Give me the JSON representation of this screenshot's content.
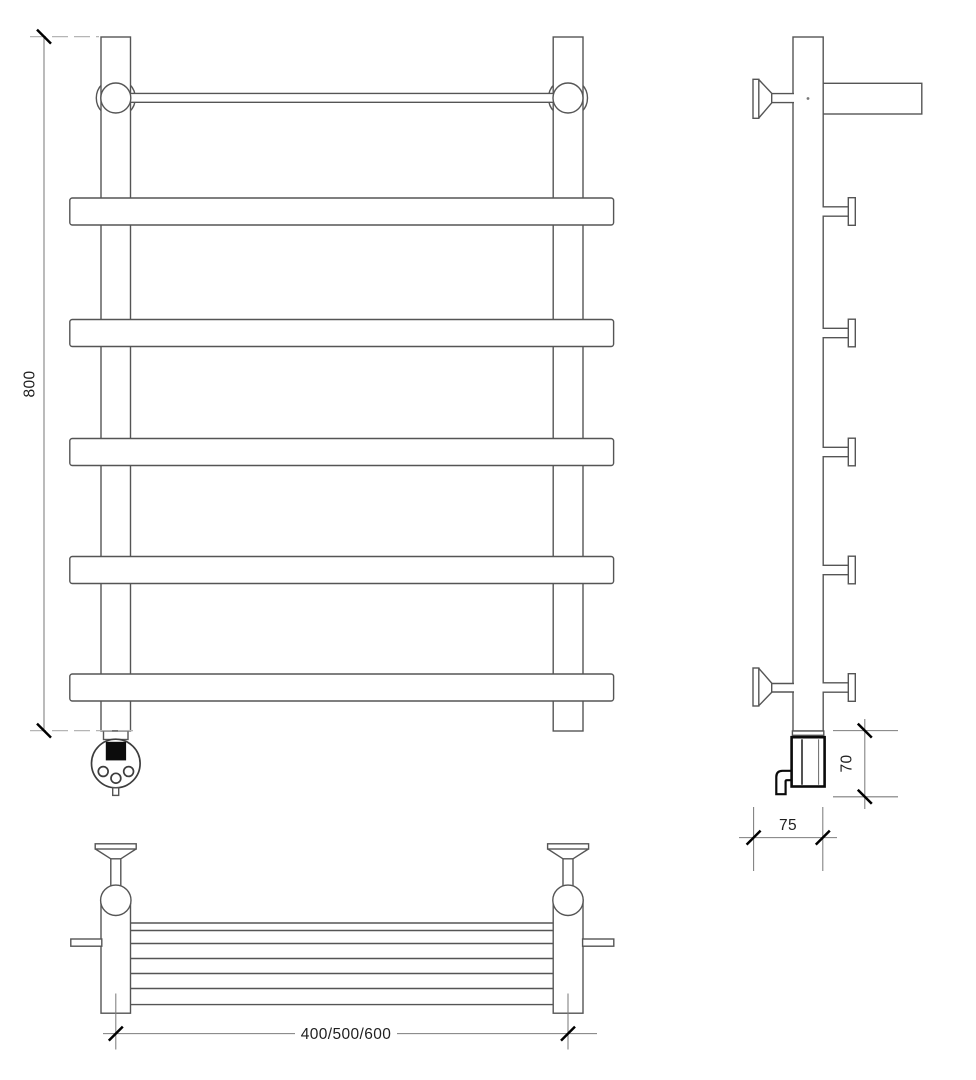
{
  "drawing": {
    "dimensions": {
      "height": "800",
      "heater_height": "70",
      "wall_depth": "75",
      "width_options": "400/500/600"
    },
    "colors": {
      "background": "#ffffff",
      "outline": "#555555",
      "dimension_line": "#7d7d7d",
      "extension_line": "#b5b5b5",
      "tick_and_heater": "#000000"
    }
  }
}
